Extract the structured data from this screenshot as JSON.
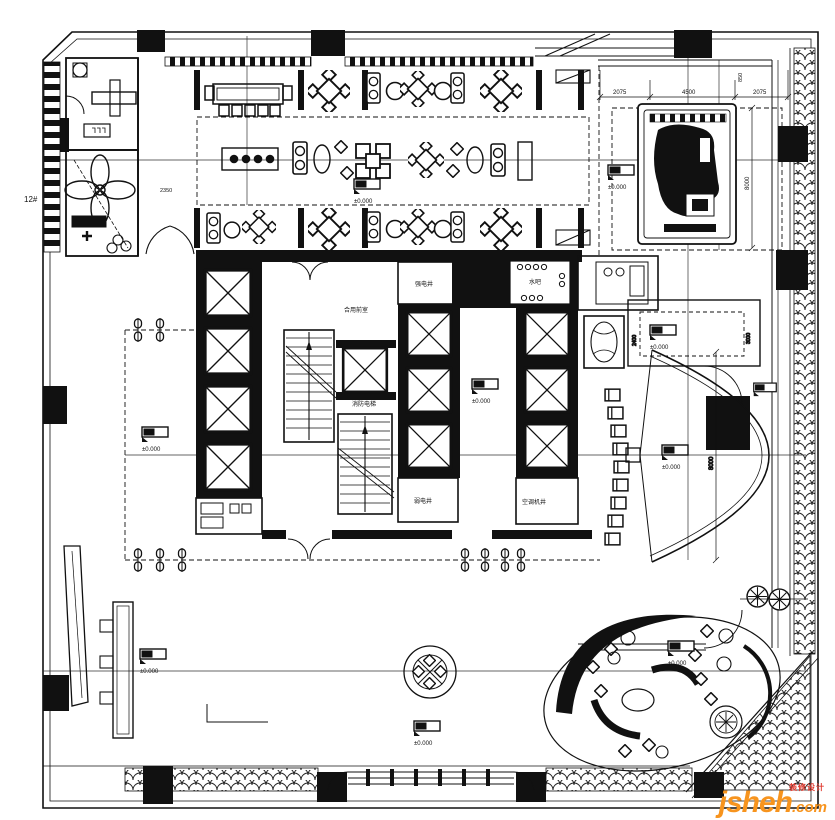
{
  "plan": {
    "unit_label": "12#",
    "elevation": "±0.000",
    "rooms": {
      "shared_front": "合用前室",
      "strong_elec": "强电井",
      "weak_elec": "弱电井",
      "fire_elev": "消防电梯",
      "ac_shaft": "空调机井",
      "water_bar": "水吧"
    },
    "dims": {
      "top_a": "2075",
      "top_b": "4500",
      "top_c": "2075",
      "top_d": "850",
      "right": "8000",
      "banquet": "2350",
      "room_w": "2400",
      "room_h": "3000",
      "fan": "8000"
    }
  },
  "watermark": {
    "brand": "jsheh",
    "tld": ".com",
    "tag": "装修设计"
  }
}
